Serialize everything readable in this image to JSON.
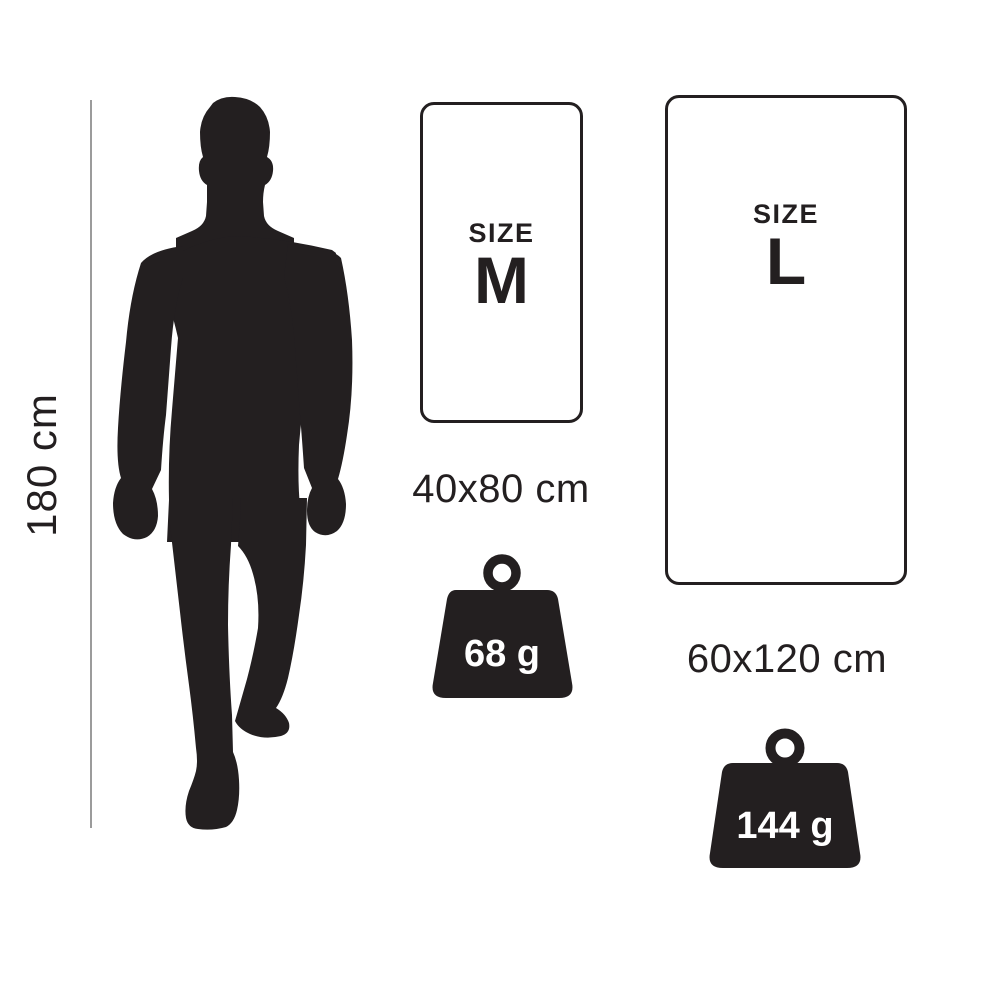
{
  "colors": {
    "background": "#ffffff",
    "ink": "#231f20",
    "measure_line": "#9b9b9b",
    "weight_text": "#ffffff"
  },
  "height_reference": {
    "label": "180 cm"
  },
  "size_cards": [
    {
      "size_word": "SIZE",
      "letter": "M",
      "dimensions": "40x80 cm",
      "weight": "68 g"
    },
    {
      "size_word": "SIZE",
      "letter": "L",
      "dimensions": "60x120 cm",
      "weight": "144 g"
    }
  ]
}
